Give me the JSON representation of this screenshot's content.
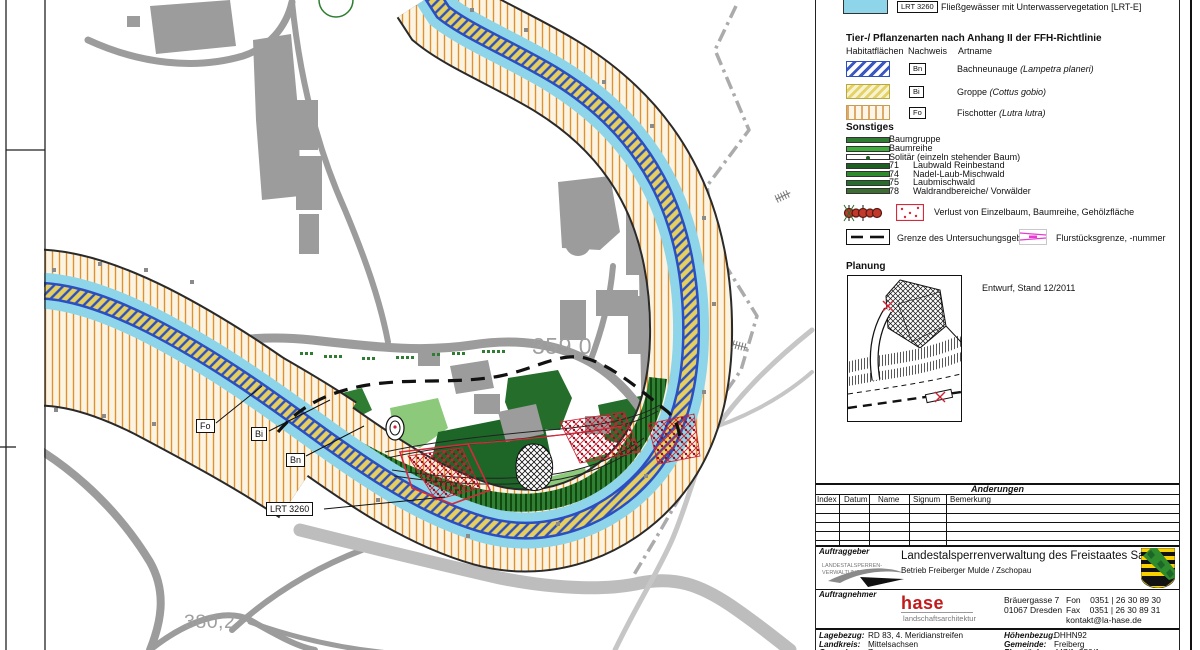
{
  "map": {
    "contour_label_upper": "359,0",
    "contour_label_lower": "380,2",
    "callouts": [
      {
        "label": "Fo"
      },
      {
        "label": "Bi"
      },
      {
        "label": "Bn"
      },
      {
        "label": "LRT 3260"
      }
    ]
  },
  "legend": {
    "lrt": {
      "code": "LRT 3260",
      "label": "Fließgewässer mit Unterwasservegetation [LRT-E]"
    },
    "species": {
      "heading": "Tier-/ Pflanzenarten nach Anhang II der FFH-Richtlinie",
      "col_habitat": "Habitatflächen",
      "col_nachweis": "Nachweis",
      "col_art": "Artname",
      "rows": [
        {
          "code": "Bn",
          "name": "Bachneunauge ",
          "latin": "(Lampetra planeri)"
        },
        {
          "code": "Bi",
          "name": "Groppe ",
          "latin": "(Cottus gobio)"
        },
        {
          "code": "Fo",
          "name": "Fischotter ",
          "latin": "(Lutra lutra)"
        }
      ]
    },
    "sonstiges": {
      "heading": "Sonstiges",
      "rows": [
        {
          "num": "",
          "label": "Baumgruppe"
        },
        {
          "num": "",
          "label": "Baumreihe"
        },
        {
          "num": "",
          "label": "Solitär (einzeln stehender Baum)"
        },
        {
          "num": "71",
          "label": "Laubwald Reinbestand"
        },
        {
          "num": "74",
          "label": "Nadel-Laub-Mischwald"
        },
        {
          "num": "75",
          "label": "Laubmischwald"
        },
        {
          "num": "78",
          "label": "Waldrandbereiche/ Vorwälder"
        }
      ],
      "verlust": "Verlust von Einzelbaum, Baumreihe, Gehölzfläche",
      "grenze": "Grenze des Untersuchungsgebietes",
      "flurstueck": "Flurstücksgrenze, -nummer"
    },
    "planung": {
      "heading": "Planung",
      "note": "Entwurf, Stand 12/2011"
    }
  },
  "aenderungen": {
    "title": "Änderungen",
    "columns": [
      "Index",
      "Datum",
      "Name",
      "Signum",
      "Bemerkung"
    ]
  },
  "titleblock": {
    "auftraggeber": {
      "label": "Auftraggeber",
      "logo_line1": "LANDESTALSPERREN-",
      "logo_line2": "VERWALTUNG",
      "org": "Landestalsperrenverwaltung des Freistaates Sachsen",
      "unit": "Betrieb Freiberger Mulde / Zschopau"
    },
    "auftragnehmer": {
      "label": "Auftragnehmer",
      "firm": "hase",
      "firm_sub": "landschaftsarchitektur",
      "street": "Bräuergasse 7",
      "city": "01067 Dresden",
      "fon": "Fon    0351 | 26 30 89 30",
      "fax": "Fax    0351 | 26 30 89 31",
      "email": "kontakt@la-hase.de"
    },
    "georef": {
      "left": [
        {
          "k": "Lagebezug:",
          "v": "RD 83, 4. Meridianstreifen"
        },
        {
          "k": "Landkreis:",
          "v": "Mittelsachsen"
        },
        {
          "k": "Gemarkung:",
          "v": "Zug"
        }
      ],
      "right": [
        {
          "k": "Höhenbezug:",
          "v": "DHHN92"
        },
        {
          "k": "Gemeinde:",
          "v": "Freiberg"
        },
        {
          "k": "Flurstück:",
          "v": "447/1, 550/1"
        }
      ]
    }
  },
  "colors": {
    "water": "#8ed5e9",
    "channel_blue": "#2b4fc0",
    "channel_yellow": "#e6cf5e",
    "otter_orange": "#df9030",
    "road_gray": "#9c9c9c",
    "forest_dark": "#1d6627",
    "forest_mid": "#2e8b33",
    "forest_light": "#8cc97b",
    "loss_red": "#d42a3c",
    "parcel_magenta": "#e63bd0",
    "hase_red": "#c21b1b",
    "saxony_yellow": "#f7d100"
  }
}
